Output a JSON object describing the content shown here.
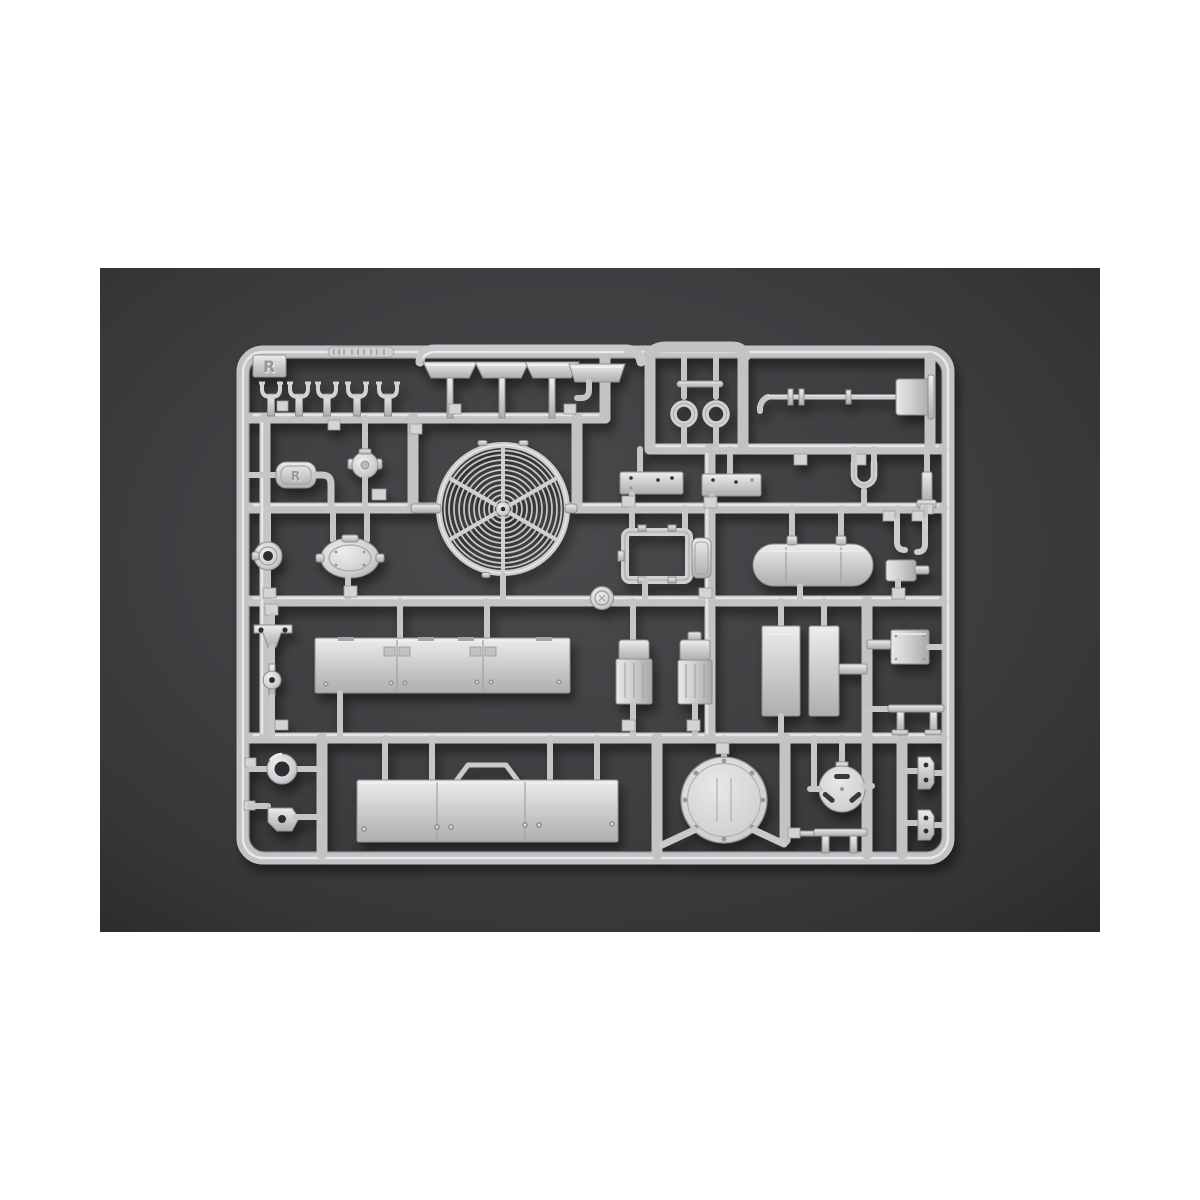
{
  "page": {
    "background": "#ffffff"
  },
  "photo": {
    "type": "product-photo",
    "subject": "injection-molded model kit parts sprue",
    "background_center": "#4a4a4d",
    "background_edge": "#2a2a2c",
    "left": 100,
    "top": 268,
    "width": 1000,
    "height": 664
  },
  "sprue": {
    "letter": "R",
    "plastic_color": "#cdcdcf",
    "plastic_highlight": "#f1f1f2",
    "plastic_shadow": "#8e8e90",
    "runner_color": "#c3c3c6",
    "parts": [
      "corner-letter-tab",
      "molded-text-strip",
      "wiper-bar",
      "pipe-clamp-x5",
      "trapezoid-pad-x4",
      "tow-eyelet-x2",
      "axle-shaft",
      "axle-end-block",
      "equipment-plate-x2",
      "tow-shackle",
      "side-post",
      "grab-handle-pill",
      "spherical-valve",
      "fan-grille",
      "round-flange",
      "oval-hatch-tank",
      "window-frame",
      "door-panel",
      "fuel-tank",
      "j-hook-x2",
      "pump-box",
      "wishbone-bracket",
      "pin-with-disc",
      "compartment-panel",
      "seat-x2",
      "storage-box-x2",
      "junction-box",
      "mounting-table",
      "grommet-ring",
      "caster-bracket",
      "skirt-panel-with-handle",
      "large-round-hatch",
      "small-round-hatch",
      "hinge-bracket-x2",
      "low-table",
      "ejector-logo-disc",
      "part-number-tabs"
    ]
  }
}
